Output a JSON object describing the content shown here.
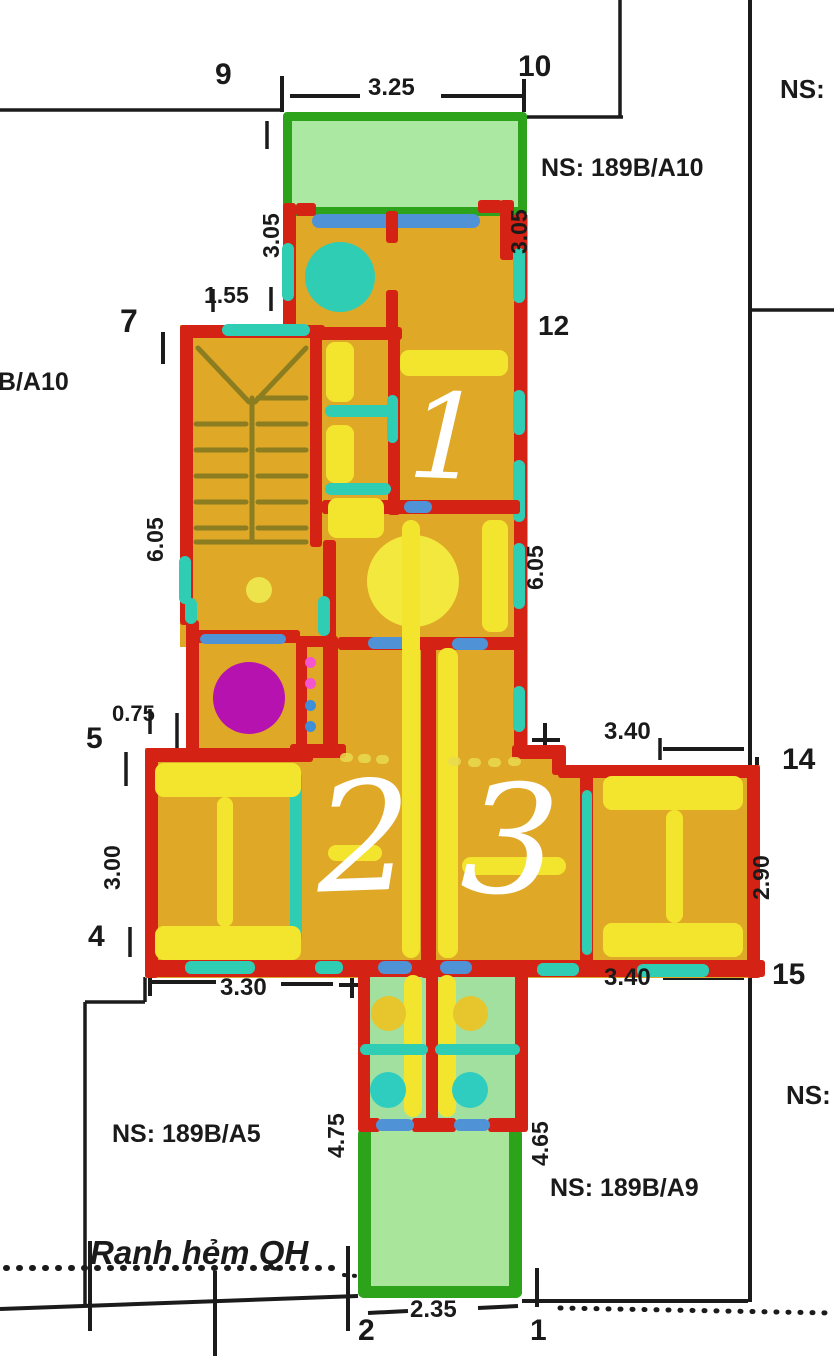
{
  "title": "Floor plan sketch with land parcel boundaries",
  "rooms": {
    "room1": "1",
    "room2": "2",
    "room3": "3"
  },
  "points": {
    "p1": "1",
    "p2": "2",
    "p4": "4",
    "p5": "5",
    "p7": "7",
    "p9": "9",
    "p10": "10",
    "p12": "12",
    "p14": "14",
    "p15": "15"
  },
  "dims": {
    "top_width": "3.25",
    "upper_left_height": "3.05",
    "upper_right_height": "3.05",
    "stair_entry": "1.55",
    "mid_left_height": "6.05",
    "mid_right_height": "6.05",
    "left_offset": "0.75",
    "left_room_height": "3.00",
    "right_room_width_top": "3.40",
    "right_room_height": "2.90",
    "right_room_width_bottom": "3.40",
    "left_bottom_width": "3.30",
    "court_left_height": "4.75",
    "court_right_height": "4.65",
    "bottom_width": "2.35"
  },
  "annotations": {
    "ns_top_right": "NS:",
    "ns_neighbor_top": "NS: 189B/A10",
    "ns_neighbor_left": "9B/A10",
    "ns_neighbor_bottom_left": "NS: 189B/A5",
    "ns_neighbor_bottom": "NS: 189B/A9",
    "ns_right_bottom": "NS:",
    "alley_boundary": "Ranh hẻm QH"
  },
  "colors": {
    "wall_red": "#d42314",
    "floor_orange": "#dfa827",
    "furniture_yellow": "#f3e52e",
    "window_teal": "#2fcdb4",
    "door_blue": "#4f92d6",
    "balcony_green_fill": "#abe8a2",
    "balcony_green_border": "#2ca31a",
    "bathroom_green": "#a2e09f",
    "kitchen_magenta": "#b512b0",
    "stair_olive": "#8b7d20",
    "boundary_black": "#1b1b1b",
    "room_number_white": "#ffffff"
  }
}
